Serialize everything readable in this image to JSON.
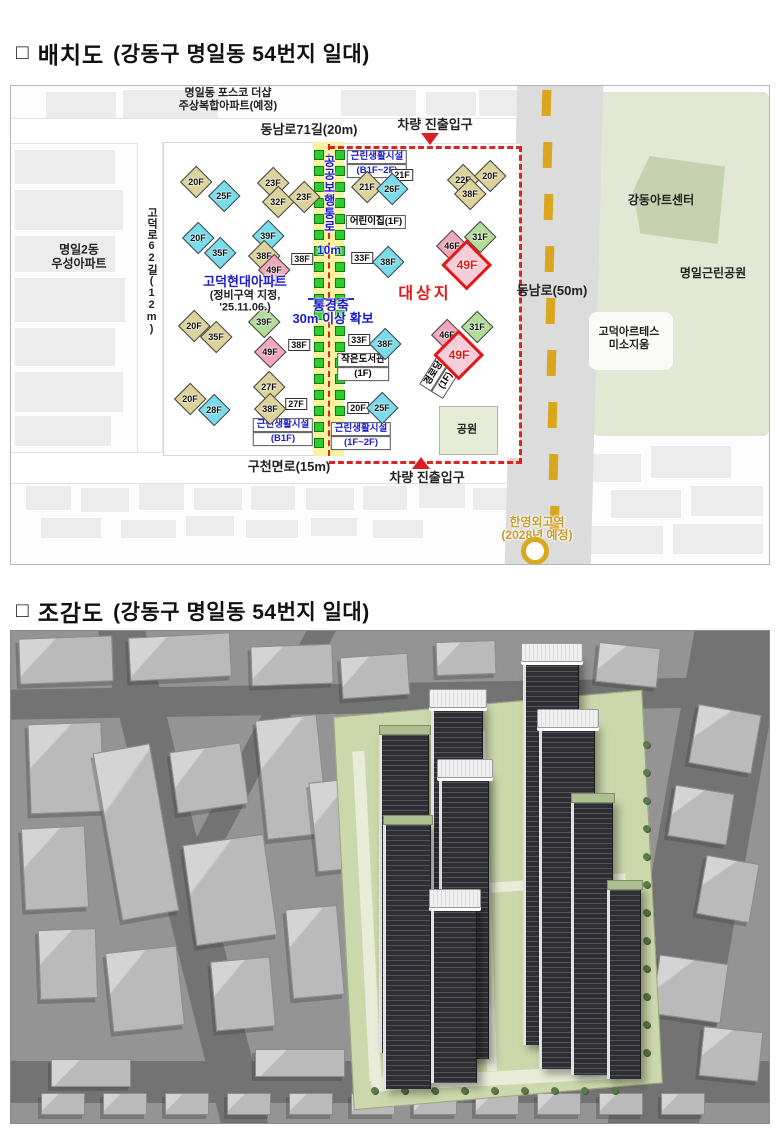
{
  "sections": [
    {
      "box": "□",
      "title": "배치도",
      "subtitle": "(강동구 명일동 54번지 일대)"
    },
    {
      "box": "□",
      "title": "조감도",
      "subtitle": "(강동구 명일동 54번지 일대)"
    }
  ],
  "colors": {
    "boundary_red": "#e02222",
    "corridor_yellow": "#f7f3a2",
    "corridor_green": "#2ecc2e",
    "road_gold": "#d9a61e",
    "label_blue": "#1c1ccc",
    "site_red": "#e01818",
    "bldg_cyan": "#79dcea",
    "bldg_tan": "#dcd29c",
    "bldg_green": "#b2dc9a",
    "bldg_pink": "#f2a8bc"
  },
  "site_plan": {
    "posco": [
      "명일동 포스코 더샵",
      "주상복합아파트(예정)"
    ],
    "wooseong": [
      "명일2동",
      "우성아파트"
    ],
    "roads": {
      "top": "동남로71길(20m)",
      "left": "고덕로62길(12m)",
      "right": "동남로(50m)",
      "bottom": "구천면로(15m)"
    },
    "entrance_top": "차량 진출입구",
    "entrance_bottom": "차량 진출입구",
    "hyundai": [
      "고덕현대아파트",
      "(정비구역 지정,",
      "'25.11.06.)"
    ],
    "corridor": {
      "vertical": "공공보행통로",
      "width": "10m"
    },
    "axis": [
      "통경축",
      "30m 이상 확보"
    ],
    "site_label": "대상지",
    "park_square": "공원",
    "art_center": "강동아트센터",
    "neighborhood_park": "명일근린공원",
    "artes": [
      "고덕아르테스",
      "미소지움"
    ],
    "station": [
      "한영외고역",
      "(2028년 예정)"
    ],
    "buildings": [
      {
        "f": "20F",
        "s": "tan",
        "x": 185,
        "y": 96
      },
      {
        "f": "25F",
        "s": "cyan",
        "x": 213,
        "y": 110
      },
      {
        "f": "23F",
        "s": "tan",
        "x": 262,
        "y": 97
      },
      {
        "f": "32F",
        "s": "tan",
        "x": 267,
        "y": 116
      },
      {
        "f": "23F",
        "s": "tan",
        "x": 293,
        "y": 111
      },
      {
        "f": "20F",
        "s": "cyan",
        "x": 187,
        "y": 152
      },
      {
        "f": "35F",
        "s": "cyan",
        "x": 209,
        "y": 167
      },
      {
        "f": "39F",
        "s": "cyan",
        "x": 257,
        "y": 150
      },
      {
        "f": "38F",
        "s": "tan",
        "x": 253,
        "y": 170
      },
      {
        "f": "38F",
        "s": "chip",
        "x": 291,
        "y": 173
      },
      {
        "f": "49F",
        "s": "pink",
        "x": 263,
        "y": 184
      },
      {
        "f": "20F",
        "s": "tan",
        "x": 183,
        "y": 240
      },
      {
        "f": "35F",
        "s": "tan",
        "x": 205,
        "y": 251
      },
      {
        "f": "39F",
        "s": "green",
        "x": 253,
        "y": 236
      },
      {
        "f": "38F",
        "s": "chip",
        "x": 288,
        "y": 259
      },
      {
        "f": "49F",
        "s": "pink",
        "x": 259,
        "y": 266
      },
      {
        "f": "27F",
        "s": "tan",
        "x": 258,
        "y": 301
      },
      {
        "f": "27F",
        "s": "chip",
        "x": 285,
        "y": 318
      },
      {
        "f": "38F",
        "s": "tan",
        "x": 259,
        "y": 323
      },
      {
        "f": "20F",
        "s": "tan",
        "x": 179,
        "y": 313
      },
      {
        "f": "28F",
        "s": "cyan",
        "x": 203,
        "y": 324
      },
      {
        "f": "21F",
        "s": "chip",
        "x": 391,
        "y": 89
      },
      {
        "f": "21F",
        "s": "tan",
        "x": 356,
        "y": 101
      },
      {
        "f": "26F",
        "s": "cyan",
        "x": 381,
        "y": 103
      },
      {
        "f": "22F",
        "s": "tan",
        "x": 452,
        "y": 94
      },
      {
        "f": "20F",
        "s": "tan",
        "x": 479,
        "y": 90
      },
      {
        "f": "38F",
        "s": "tan",
        "x": 459,
        "y": 108
      },
      {
        "f": "33F",
        "s": "chip",
        "x": 351,
        "y": 172
      },
      {
        "f": "38F",
        "s": "cyan",
        "x": 377,
        "y": 176
      },
      {
        "f": "31F",
        "s": "green",
        "x": 469,
        "y": 151
      },
      {
        "f": "46F",
        "s": "pink",
        "x": 441,
        "y": 160
      },
      {
        "f": "49F",
        "s": "red",
        "x": 456,
        "y": 179
      },
      {
        "f": "33F",
        "s": "chip",
        "x": 348,
        "y": 254
      },
      {
        "f": "38F",
        "s": "cyan",
        "x": 374,
        "y": 258
      },
      {
        "f": "31F",
        "s": "green",
        "x": 466,
        "y": 241
      },
      {
        "f": "46F",
        "s": "pink",
        "x": 436,
        "y": 249
      },
      {
        "f": "49F",
        "s": "red",
        "x": 448,
        "y": 269
      },
      {
        "f": "20F",
        "s": "chip",
        "x": 347,
        "y": 322
      },
      {
        "f": "25F",
        "s": "cyan",
        "x": 371,
        "y": 322
      }
    ],
    "facilities": [
      {
        "lines": [
          "근린생활시설",
          "(B1F~2F)"
        ],
        "x": 366,
        "y": 78,
        "blue": true,
        "rot": 0
      },
      {
        "lines": [
          "어린이집(1F)"
        ],
        "x": 365,
        "y": 136,
        "blue": false,
        "rot": 0
      },
      {
        "lines": [
          "작은도서관",
          "(1F)"
        ],
        "x": 352,
        "y": 281,
        "blue": false,
        "rot": 0
      },
      {
        "lines": [
          "근린생활시설",
          "(B1F)"
        ],
        "x": 272,
        "y": 346,
        "blue": true,
        "rot": 0
      },
      {
        "lines": [
          "근린생활시설",
          "(1F~2F)"
        ],
        "x": 350,
        "y": 350,
        "blue": true,
        "rot": 0
      },
      {
        "lines": [
          "경로당",
          "(1F)"
        ],
        "x": 429,
        "y": 291,
        "blue": false,
        "rot": -58
      }
    ]
  },
  "aerial_view": {
    "towers": [
      {
        "x": 368,
        "y": 100,
        "w": 46,
        "h": 322,
        "cap": false
      },
      {
        "x": 512,
        "y": 26,
        "w": 52,
        "h": 388,
        "cap": true
      },
      {
        "x": 420,
        "y": 72,
        "w": 48,
        "h": 298,
        "cap": true
      },
      {
        "x": 528,
        "y": 92,
        "w": 52,
        "h": 346,
        "cap": true
      },
      {
        "x": 560,
        "y": 168,
        "w": 38,
        "h": 276,
        "cap": false
      },
      {
        "x": 428,
        "y": 142,
        "w": 46,
        "h": 286,
        "cap": true
      },
      {
        "x": 372,
        "y": 190,
        "w": 44,
        "h": 268,
        "cap": false
      },
      {
        "x": 596,
        "y": 255,
        "w": 30,
        "h": 193,
        "cap": false
      },
      {
        "x": 420,
        "y": 272,
        "w": 42,
        "h": 180,
        "cap": true
      }
    ]
  }
}
